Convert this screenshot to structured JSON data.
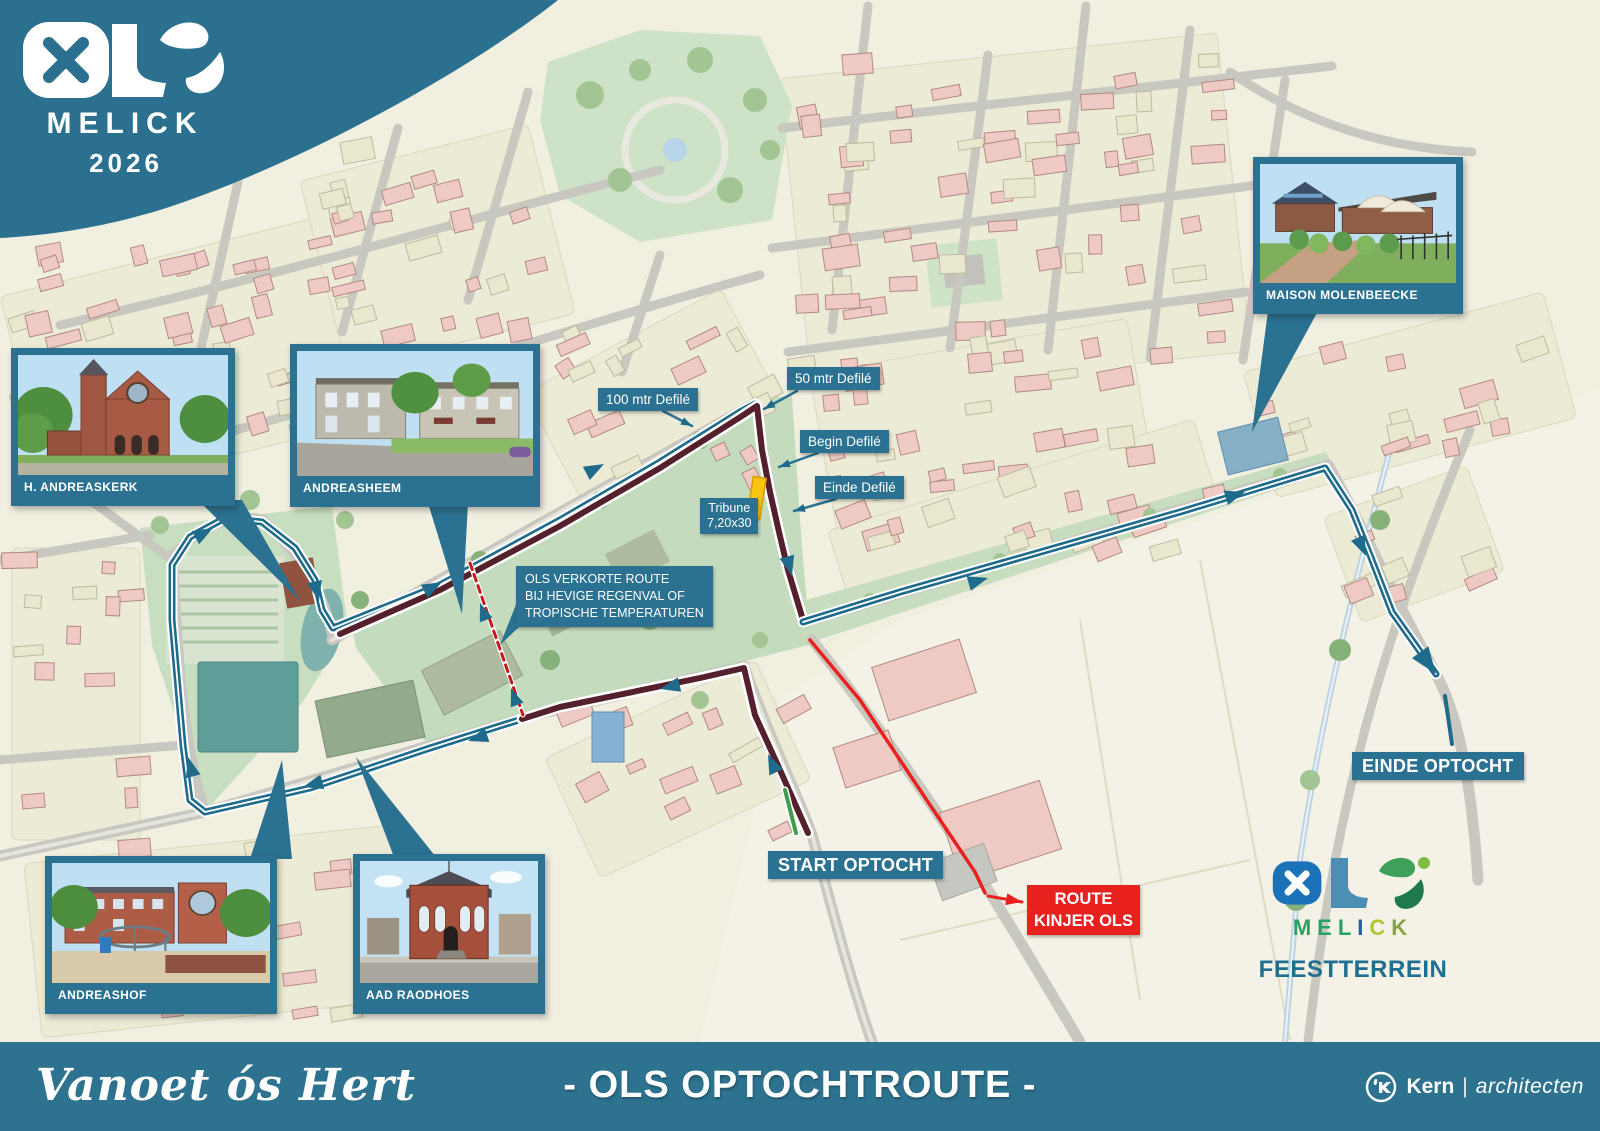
{
  "banner": {
    "word": "OLS",
    "place": "MELICK",
    "year": "2026"
  },
  "insets": [
    {
      "label": "H. ANDREASKERK"
    },
    {
      "label": "ANDREASHEEM"
    },
    {
      "label": "MAISON MOLENBEECKE"
    },
    {
      "label": "ANDREASHOF"
    },
    {
      "label": "AAD RAODHOES"
    }
  ],
  "route_labels": {
    "defile_100": "100 mtr Defilé",
    "defile_50": "50 mtr Defilé",
    "defile_begin": "Begin Defilé",
    "defile_einde": "Einde Defilé",
    "tribune_line1": "Tribune",
    "tribune_line2": "7,20x30",
    "verkorte_line1": "OLS VERKORTE ROUTE",
    "verkorte_line2": "BIJ HEVIGE REGENVAL OF",
    "verkorte_line3": "TROPISCHE TEMPERATUREN",
    "start": "START OPTOCHT",
    "einde": "EINDE OPTOCHT",
    "kinjer_line1": "ROUTE",
    "kinjer_line2": "KINJER OLS"
  },
  "feest": {
    "word": "OLS",
    "melick_letters": [
      {
        "ch": "M",
        "color": "#2AA061"
      },
      {
        "ch": "E",
        "color": "#2AA061"
      },
      {
        "ch": "L",
        "color": "#2AA061"
      },
      {
        "ch": "I",
        "color": "#1A5FA8"
      },
      {
        "ch": "C",
        "color": "#B2C433"
      },
      {
        "ch": "K",
        "color": "#84A33E"
      }
    ],
    "caption": "FEESTTERREIN"
  },
  "footer": {
    "slogan": "Vanoet ós Hert",
    "title": "- OLS OPTOCHTROUTE -",
    "credit_bold": "Kern",
    "credit_sep": "|",
    "credit_light": "architecten"
  },
  "colors": {
    "brand_teal": "#2B7191",
    "route_teal": "#1F6B8C",
    "route_maroon": "#54202C",
    "route_red": "#E8201E",
    "tribune_yellow": "#F8C412",
    "feest_caption": "#1E6F90"
  }
}
